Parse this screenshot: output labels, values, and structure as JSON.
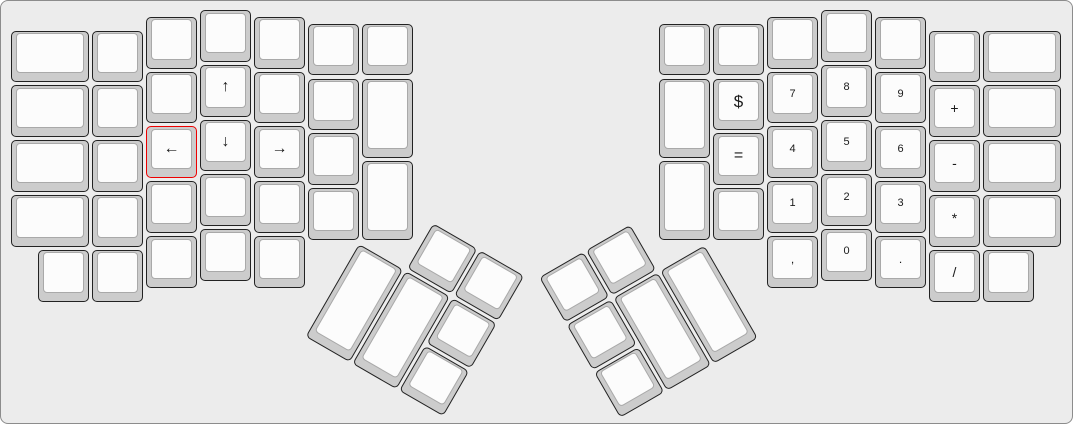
{
  "canvas": {
    "background": "#ececec",
    "border_color": "#8c8c8c",
    "page_background": "#ffffff"
  },
  "key_style": {
    "base_color": "#cccccc",
    "top_color": "#fcfcfc",
    "border_color": "#222222",
    "top_border_color": "#a9a9a9",
    "legend_color": "#1a1a1a",
    "highlight_border_color": "#ee0000"
  },
  "layout": {
    "unit_x": 54,
    "unit_y": 54.8,
    "groups": [
      {
        "name": "left-main-keys",
        "origin_x": 11,
        "origin_y": 10,
        "rotation": 0,
        "keys": [
          {
            "x": 0,
            "y": 0.375,
            "w": 1.5
          },
          {
            "x": 0,
            "y": 1.375,
            "w": 1.5
          },
          {
            "x": 0,
            "y": 2.375,
            "w": 1.5
          },
          {
            "x": 0,
            "y": 3.375,
            "w": 1.5
          },
          {
            "x": 0.5,
            "y": 4.375
          },
          {
            "x": 1.5,
            "y": 0.375
          },
          {
            "x": 1.5,
            "y": 1.375
          },
          {
            "x": 1.5,
            "y": 2.375
          },
          {
            "x": 1.5,
            "y": 3.375
          },
          {
            "x": 1.5,
            "y": 4.375
          },
          {
            "x": 2.5,
            "y": 0.125
          },
          {
            "x": 2.5,
            "y": 1.125
          },
          {
            "x": 2.5,
            "y": 2.125,
            "label": "←",
            "fs": 16,
            "name": "key-left-arrow",
            "highlight": true
          },
          {
            "x": 2.5,
            "y": 3.125
          },
          {
            "x": 2.5,
            "y": 4.125
          },
          {
            "x": 3.5,
            "y": 0
          },
          {
            "x": 3.5,
            "y": 1,
            "label": "↑",
            "fs": 16,
            "name": "key-up-arrow"
          },
          {
            "x": 3.5,
            "y": 2,
            "label": "↓",
            "fs": 16,
            "name": "key-down-arrow"
          },
          {
            "x": 3.5,
            "y": 3
          },
          {
            "x": 3.5,
            "y": 4
          },
          {
            "x": 4.5,
            "y": 0.125
          },
          {
            "x": 4.5,
            "y": 1.125
          },
          {
            "x": 4.5,
            "y": 2.125,
            "label": "→",
            "fs": 16,
            "name": "key-right-arrow"
          },
          {
            "x": 4.5,
            "y": 3.125
          },
          {
            "x": 4.5,
            "y": 4.125
          },
          {
            "x": 5.5,
            "y": 0.25
          },
          {
            "x": 5.5,
            "y": 1.25
          },
          {
            "x": 5.5,
            "y": 2.25
          },
          {
            "x": 5.5,
            "y": 3.25
          },
          {
            "x": 6.5,
            "y": 0.25
          },
          {
            "x": 6.5,
            "y": 1.25,
            "h": 1.5
          },
          {
            "x": 6.5,
            "y": 2.75,
            "h": 1.5
          }
        ]
      },
      {
        "name": "right-main-keys",
        "origin_x": 659,
        "origin_y": 10,
        "rotation": 0,
        "keys": [
          {
            "x": 0,
            "y": 0.25
          },
          {
            "x": 0,
            "y": 1.25,
            "h": 1.5
          },
          {
            "x": 0,
            "y": 2.75,
            "h": 1.5
          },
          {
            "x": 1,
            "y": 0.25
          },
          {
            "x": 1,
            "y": 1.25,
            "label": "$",
            "fs": 17,
            "name": "key-dollar"
          },
          {
            "x": 1,
            "y": 2.25,
            "label": "=",
            "fs": 16,
            "name": "key-equals"
          },
          {
            "x": 1,
            "y": 3.25
          },
          {
            "x": 2,
            "y": 0.125
          },
          {
            "x": 2,
            "y": 1.125,
            "label": "7",
            "fs": 11,
            "name": "key-7"
          },
          {
            "x": 2,
            "y": 2.125,
            "label": "4",
            "fs": 11,
            "name": "key-4"
          },
          {
            "x": 2,
            "y": 3.125,
            "label": "1",
            "fs": 11,
            "name": "key-1"
          },
          {
            "x": 2,
            "y": 4.125,
            "label": ",",
            "fs": 12,
            "name": "key-comma"
          },
          {
            "x": 3,
            "y": 0
          },
          {
            "x": 3,
            "y": 1,
            "label": "8",
            "fs": 11,
            "name": "key-8"
          },
          {
            "x": 3,
            "y": 2,
            "label": "5",
            "fs": 11,
            "name": "key-5"
          },
          {
            "x": 3,
            "y": 3,
            "label": "2",
            "fs": 11,
            "name": "key-2"
          },
          {
            "x": 3,
            "y": 4,
            "label": "0",
            "fs": 11,
            "name": "key-0"
          },
          {
            "x": 4,
            "y": 0.125
          },
          {
            "x": 4,
            "y": 1.125,
            "label": "9",
            "fs": 11,
            "name": "key-9"
          },
          {
            "x": 4,
            "y": 2.125,
            "label": "6",
            "fs": 11,
            "name": "key-6"
          },
          {
            "x": 4,
            "y": 3.125,
            "label": "3",
            "fs": 11,
            "name": "key-3"
          },
          {
            "x": 4,
            "y": 4.125,
            "label": ".",
            "fs": 12,
            "name": "key-period"
          },
          {
            "x": 5,
            "y": 0.375
          },
          {
            "x": 5,
            "y": 1.375,
            "label": "+",
            "fs": 14,
            "name": "key-plus"
          },
          {
            "x": 5,
            "y": 2.375,
            "label": "-",
            "fs": 14,
            "name": "key-minus"
          },
          {
            "x": 5,
            "y": 3.375,
            "label": "*",
            "fs": 14,
            "name": "key-asterisk"
          },
          {
            "x": 5,
            "y": 4.375,
            "label": "/",
            "fs": 14,
            "name": "key-slash"
          },
          {
            "x": 6,
            "y": 0.375,
            "w": 1.5
          },
          {
            "x": 6,
            "y": 1.375,
            "w": 1.5
          },
          {
            "x": 6,
            "y": 2.375,
            "w": 1.5
          },
          {
            "x": 6,
            "y": 3.375,
            "w": 1.5
          },
          {
            "x": 6,
            "y": 4.375
          }
        ]
      },
      {
        "name": "left-thumb-cluster",
        "origin_x": 358.5,
        "origin_y": 243.5,
        "rotation": 30,
        "keys": [
          {
            "x": 1,
            "y": -1
          },
          {
            "x": 2,
            "y": -1
          },
          {
            "x": 0,
            "y": 0,
            "h": 2
          },
          {
            "x": 1,
            "y": 0,
            "h": 2
          },
          {
            "x": 2,
            "y": 0
          },
          {
            "x": 2,
            "y": 1
          }
        ]
      },
      {
        "name": "right-thumb-cluster",
        "origin_x": 707,
        "origin_y": 243.5,
        "rotation": -30,
        "keys": [
          {
            "x": -3,
            "y": -1
          },
          {
            "x": -2,
            "y": -1
          },
          {
            "x": -3,
            "y": 0
          },
          {
            "x": -2,
            "y": 0,
            "h": 2
          },
          {
            "x": -1,
            "y": 0,
            "h": 2
          },
          {
            "x": -3,
            "y": 1
          }
        ]
      }
    ]
  }
}
